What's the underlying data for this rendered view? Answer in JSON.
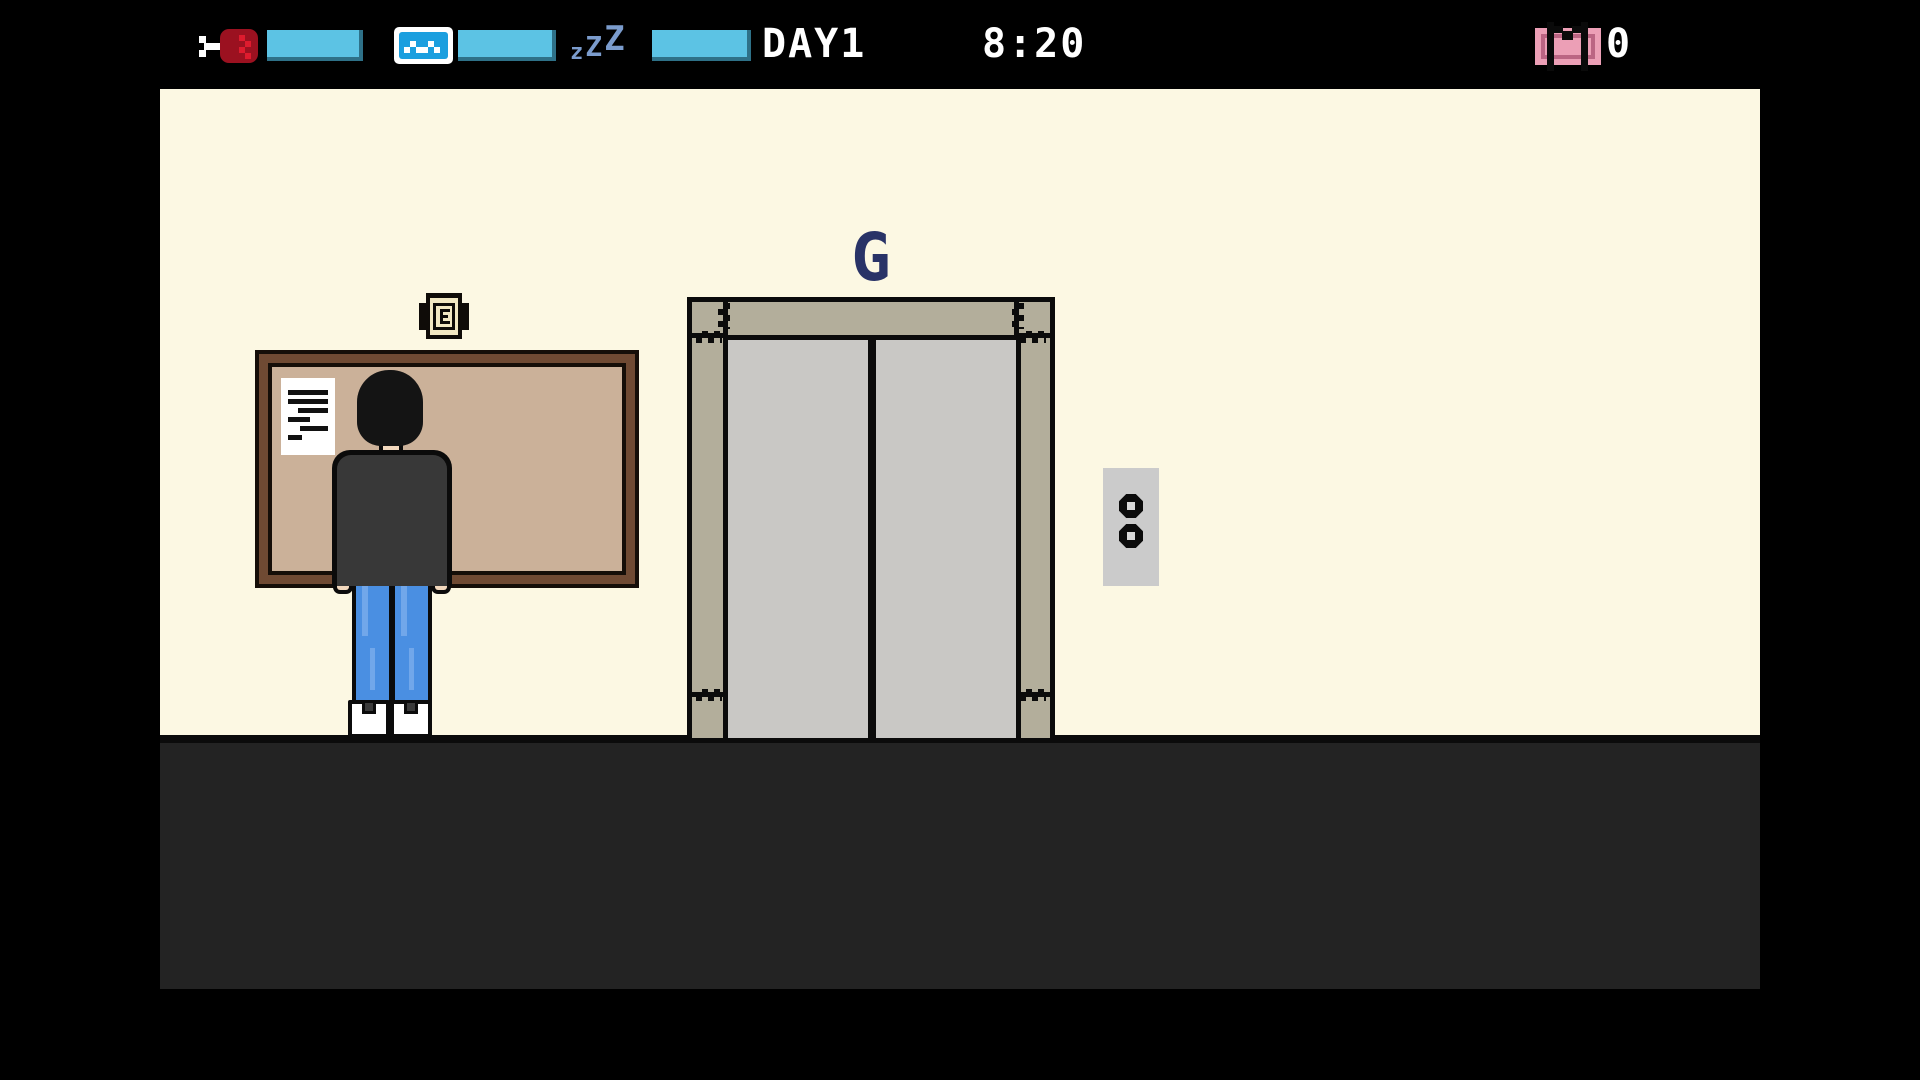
{
  "hud": {
    "cursor_icon": "bone-selector-cursor",
    "stats": [
      {
        "name": "hunger",
        "icon": "meat-icon",
        "fill_percent": 100
      },
      {
        "name": "happiness",
        "icon": "wave-icon",
        "fill_percent": 100
      },
      {
        "name": "energy",
        "icon": "sleep-zzz-icon",
        "fill_percent": 100
      }
    ],
    "sleep_letters": [
      "z",
      "Z",
      "Z"
    ],
    "day_label": "DAY1",
    "time": "8:20",
    "money_amount": "0",
    "money_icon": "banknote-m-icon"
  },
  "scene": {
    "elevator": {
      "floor_label": "G",
      "doors": "closed",
      "call_buttons": 2
    },
    "bulletin_board": {
      "paper_present": true,
      "indicator_icon": "note-e-icon"
    },
    "player": {
      "pose": "standing-back",
      "location": "facing-bulletin-board"
    }
  },
  "colors": {
    "bar_blue": "#5CC3E4",
    "meat_red": "#9B1120",
    "wave_blue": "#1B9FDF",
    "sleep_blue": "#7B9CCD",
    "money_pink": "#EC9FB6",
    "wall_cream": "#FCF8E3",
    "floor_dark": "#232323",
    "frame_greige": "#B3AE9B",
    "door_gray": "#C9C8C5",
    "board_tan": "#CBB199",
    "board_brown": "#6F4A33",
    "label_navy": "#293367",
    "jeans_blue": "#4A8FE2",
    "skin": "#F2D8BD",
    "shirt": "#383838"
  }
}
